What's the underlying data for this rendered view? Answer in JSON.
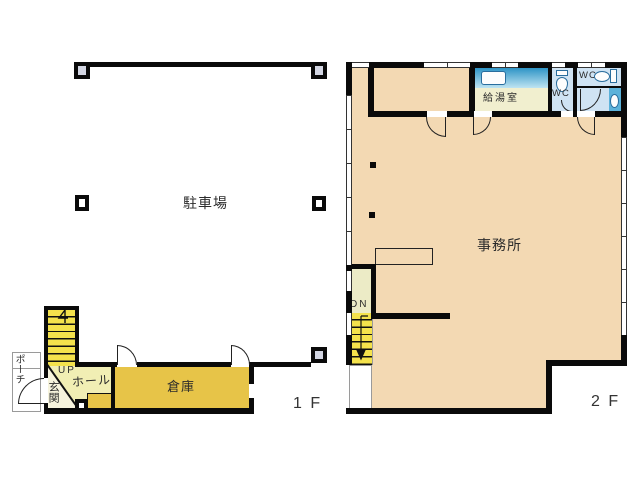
{
  "palette": {
    "wall": "#0a0a0a",
    "office_peach": "#f3d9b3",
    "storage_gold": "#e7c448",
    "stair_yellow": "#f4e24c",
    "hall_yellow": "#f1eeb4",
    "entrance_cream": "#f6f3dd",
    "dn_cream": "#ecebc6",
    "kitchen_cream": "#f1efcf",
    "wc_blue": "#cfe3f3",
    "counter_blue_dark": "#2e94c6",
    "counter_blue_light": "#bfe4f2",
    "basin_blue": "#5cb2da",
    "pillar_fill": "#d3d6e3",
    "text": "#2b2b2b"
  },
  "floor1": {
    "floor_label": "1 F",
    "parking_label": "駐車場",
    "storage_label": "倉庫",
    "entrance_label": "玄関",
    "hall_label": "ホール",
    "porch_label": "ポーチ",
    "up_label": "UP"
  },
  "floor2": {
    "floor_label": "2 F",
    "office_label": "事務所",
    "kitchen_label": "給湯室",
    "wc_left_label": "WC",
    "wc_right_label": "WC",
    "dn_label": "DN"
  }
}
